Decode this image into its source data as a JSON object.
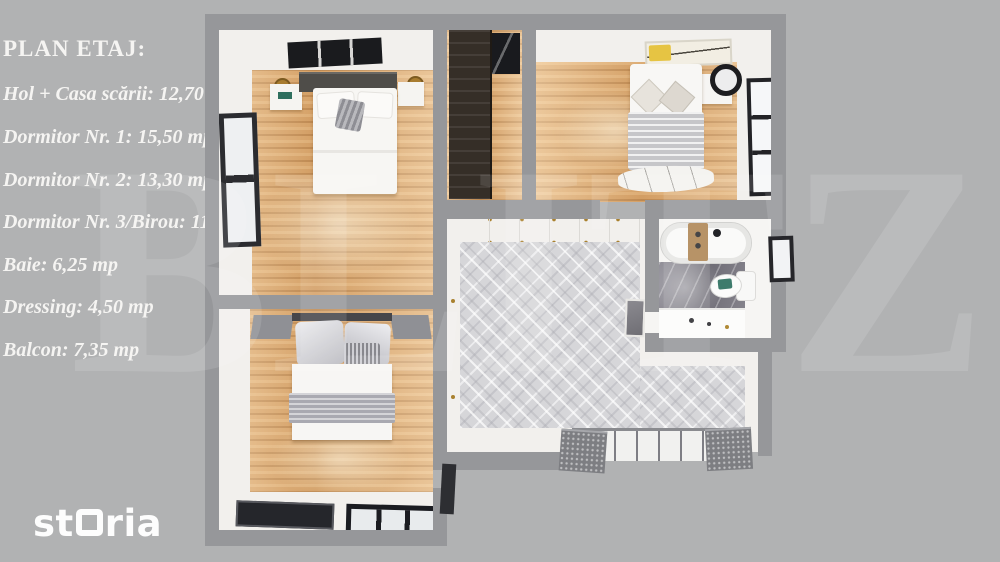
{
  "panel": {
    "title": "PLAN ETAJ:",
    "items": [
      "Hol + Casa scării: 12,70 mp",
      "Dormitor Nr. 1: 15,50 mp",
      "Dormitor Nr. 2: 13,30 mp",
      "Dormitor Nr. 3/Birou: 11,70 mp",
      "Baie: 6,25 mp",
      "Dressing: 4,50 mp",
      "Balcon: 7,35 mp"
    ]
  },
  "watermark": {
    "letters": [
      "B",
      "L",
      "I",
      "T",
      "Z"
    ]
  },
  "logo": {
    "part1": "st",
    "part2": "ria"
  },
  "colors": {
    "background": "#b1b2b3",
    "wall": "#96979a",
    "text": "#f5f4f2",
    "wood_floor": "#dcaa72",
    "tile_floor": "#d6d6d9",
    "marble": "#6f6d76",
    "gold_accent": "#a9812f",
    "logo": "#fdfdfd"
  }
}
